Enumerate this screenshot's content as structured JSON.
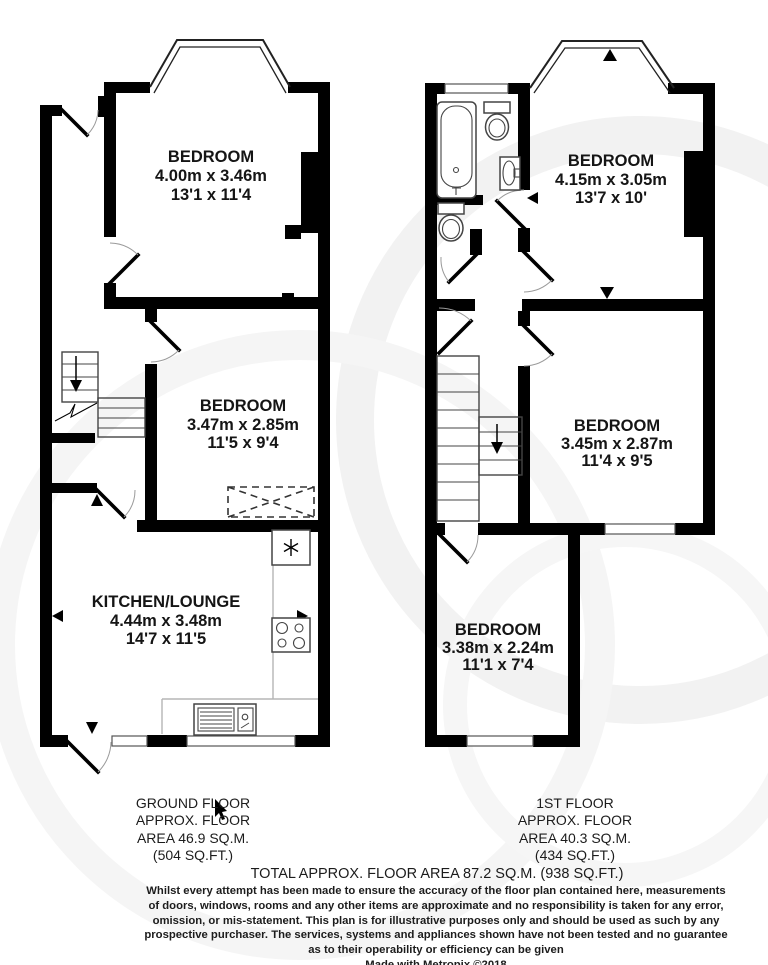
{
  "colors": {
    "wall": "#000000",
    "fixture_line": "#444444",
    "counter_line": "#b5b5b5",
    "watermark": "#f2f2f2",
    "text": "#1c1c1c"
  },
  "ground_floor": {
    "rooms": [
      {
        "name": "BEDROOM",
        "metric": "4.00m x 3.46m",
        "imperial": "13'1 x 11'4"
      },
      {
        "name": "BEDROOM",
        "metric": "3.47m x 2.85m",
        "imperial": "11'5 x 9'4"
      },
      {
        "name": "KITCHEN/LOUNGE",
        "metric": "4.44m x 3.48m",
        "imperial": "14'7 x 11'5"
      }
    ],
    "fixtures": [
      "fridge-icon",
      "hob-icon",
      "sink-icon",
      "stairs-down",
      "wardrobe-dashed"
    ],
    "area_label": {
      "floor": "GROUND FLOOR",
      "approx": "APPROX. FLOOR",
      "area_m": "AREA 46.9 SQ.M.",
      "area_ft": "(504 SQ.FT.)"
    }
  },
  "first_floor": {
    "rooms": [
      {
        "name": "BEDROOM",
        "metric": "4.15m x 3.05m",
        "imperial": "13'7 x 10'"
      },
      {
        "name": "BEDROOM",
        "metric": "3.45m x 2.87m",
        "imperial": "11'4 x 9'5"
      },
      {
        "name": "BEDROOM",
        "metric": "3.38m x 2.24m",
        "imperial": "11'1 x 7'4"
      }
    ],
    "fixtures": [
      "bath-icon",
      "toilet-icon",
      "basin-icon",
      "wc-toilet-icon",
      "stairs-down"
    ],
    "area_label": {
      "floor": "1ST FLOOR",
      "approx": "APPROX. FLOOR",
      "area_m": "AREA 40.3 SQ.M.",
      "area_ft": "(434 SQ.FT.)"
    }
  },
  "totals": {
    "total_area": "TOTAL APPROX. FLOOR AREA 87.2 SQ.M. (938 SQ.FT.)"
  },
  "disclaimer": {
    "line1": "Whilst every attempt has been made to ensure the accuracy of the floor plan contained here, measurements",
    "line2": "of doors, windows, rooms and any other items are approximate and no responsibility is taken for any error,",
    "line3": "omission, or mis-statement. This plan is for illustrative purposes only and should be used as such by any",
    "line4": "prospective purchaser. The services, systems and appliances shown have not been tested and no guarantee",
    "line5": "as to their operability or efficiency can be given",
    "credit": "Made with Metropix ©2018"
  }
}
